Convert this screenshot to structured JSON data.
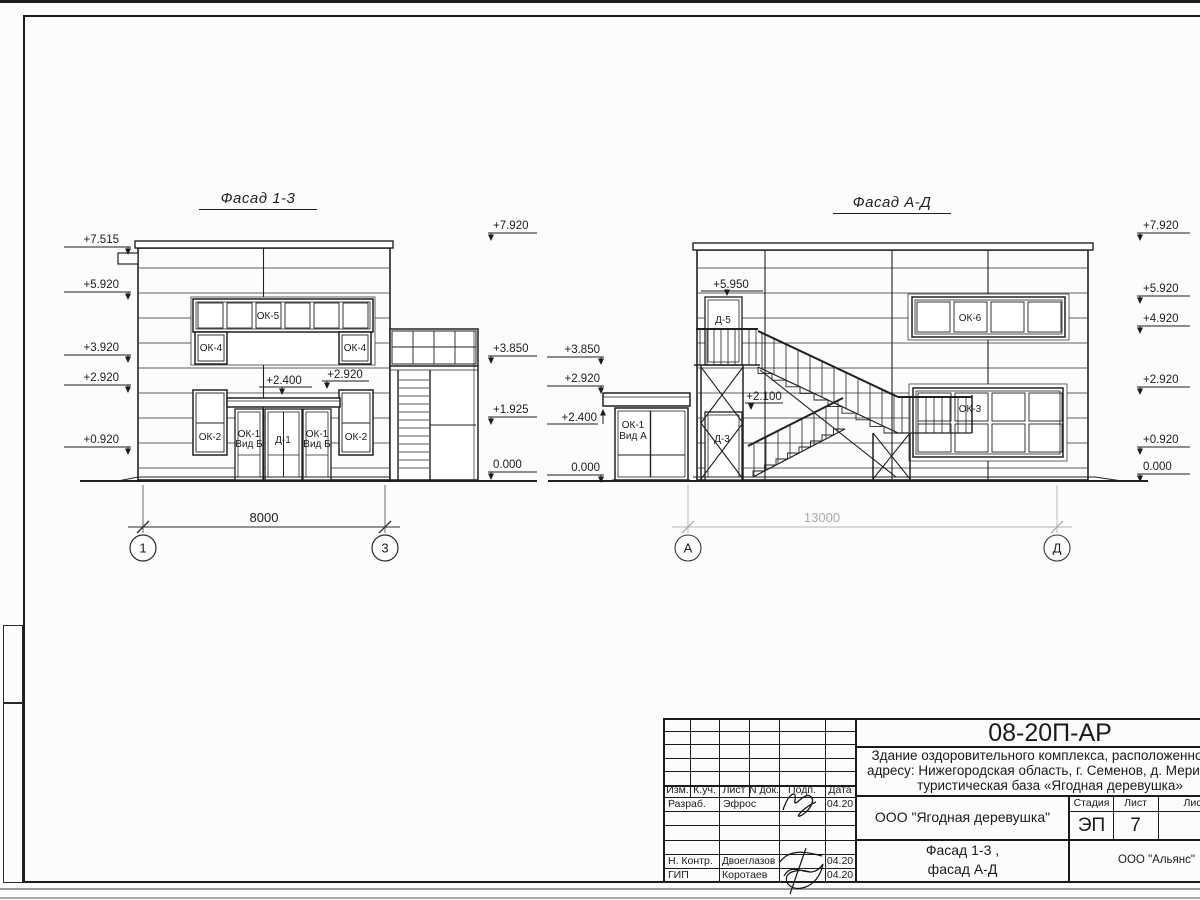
{
  "facade13": {
    "title": "Фасад 1-3",
    "marks_left": [
      "+7.515",
      "+5.920",
      "+3.920",
      "+2.920",
      "+0.920"
    ],
    "marks_right": [
      "+7.920",
      "+3.850",
      "+1.925",
      "0.000"
    ],
    "canopy_marks": [
      "+2.400",
      "+2.920"
    ],
    "windows": {
      "ok5": "ОК-5",
      "ok4": "ОК-4",
      "ok2": "ОК-2",
      "ok1_line1": "ОК-1",
      "ok1_line2": "Вид Б",
      "d1": "Д-1"
    },
    "dimension": "8000",
    "axis_left": "1",
    "axis_right": "3"
  },
  "facadeAD": {
    "title": "Фасад А-Д",
    "marks_left": [
      "+3.850",
      "+2.920",
      "+2.400",
      "0.000"
    ],
    "marks_right": [
      "+7.920",
      "+5.920",
      "+4.920",
      "+2.920",
      "+0.920",
      "0.000"
    ],
    "door_marks": [
      "+5.950",
      "+2.100"
    ],
    "windows": {
      "d5": "Д-5",
      "d3": "Д-3",
      "ok6": "ОК-6",
      "ok3": "ОК-3",
      "ok1_line1": "ОК-1",
      "ok1_line2": "Вид А"
    },
    "dimension": "13000",
    "axis_left": "А",
    "axis_right": "Д"
  },
  "titleblock": {
    "code": "08-20П-АР",
    "desc_line1": "Здание оздоровительного комплекса, расположенное по",
    "desc_line2": "адресу: Нижегородская область, г. Семенов, д. Мериново,",
    "desc_line3": "туристическая база «Ягодная деревушка»",
    "cols": {
      "izm": "Изм.",
      "kuch": "К.уч.",
      "list": "Лист",
      "ndok": "N док.",
      "podp": "Подп.",
      "data": "Дата"
    },
    "rows": {
      "r1_role": "Разраб.",
      "r1_name": "Эфрос",
      "r1_date": "04.20",
      "r5_role": "Н. Контр.",
      "r5_name": "Двоеглазов",
      "r5_date": "04.20",
      "r6_role": "ГИП",
      "r6_name": "Коротаев",
      "r6_date": "04.20"
    },
    "org1": "ООО \"Ягодная деревушка\"",
    "stage_label": "Стадия",
    "list_label": "Лист",
    "listov_label": "Листов",
    "stage": "ЭП",
    "sheet_no": "7",
    "doc_title_line1": "Фасад 1-3 ,",
    "doc_title_line2": "фасад А-Д",
    "org2": "ООО \"Альянс\""
  }
}
